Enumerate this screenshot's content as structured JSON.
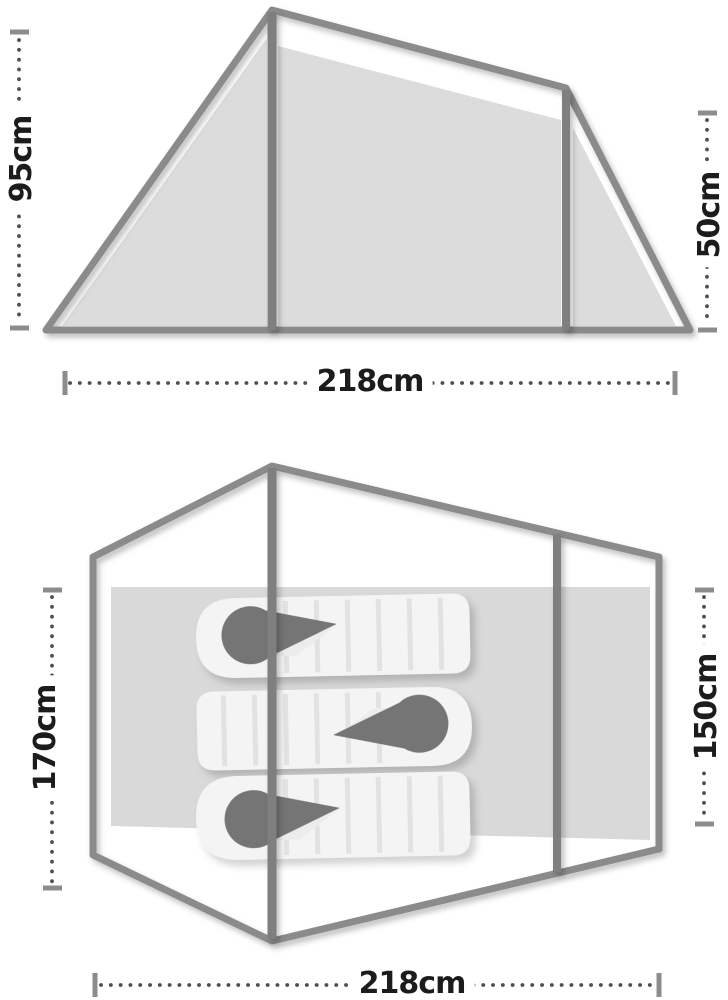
{
  "diagram": {
    "title": "tent dimensions diagram",
    "side_view": {
      "peak_height_label": "95cm",
      "rear_height_label": "50cm",
      "length_label": "218cm"
    },
    "floor_plan": {
      "left_width_label": "170cm",
      "right_width_label": "150cm",
      "length_label": "218cm",
      "sleeping_bag_count": 3
    },
    "colors": {
      "outline_gray": "#8b8b8b",
      "panel_fill": "#dcdcdc",
      "mat_fill": "#d9d9d9",
      "bag_fill": "#f4f4f4",
      "baffle_line": "#e2e2e2",
      "hood_gray": "#757575",
      "dimension_dot": "#4f4f4f",
      "dimension_cap": "#8c8c8c",
      "text_black": "#1c1c1c"
    }
  }
}
